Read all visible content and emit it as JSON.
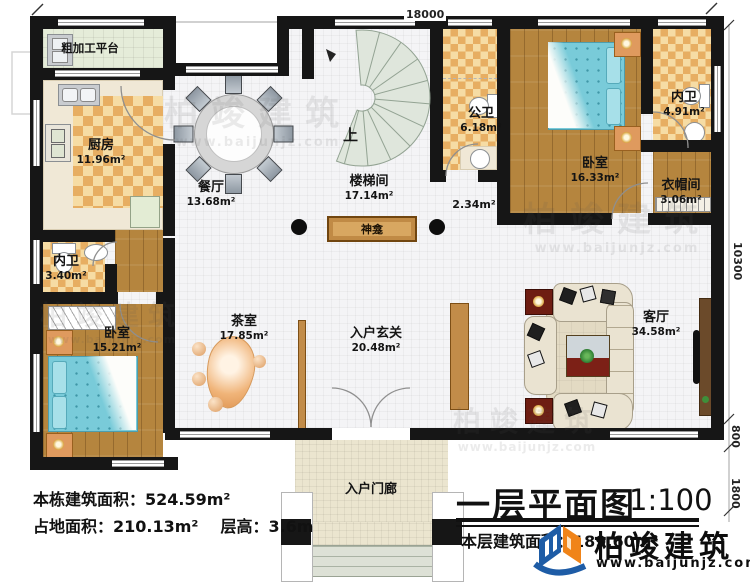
{
  "brand": {
    "name": "柏竣建筑",
    "url": "www.baijunjz.com"
  },
  "title": {
    "main": "一层平面图",
    "scale": "1:100",
    "floor_area": "本层建筑面积：189.60m²"
  },
  "stats": {
    "building_area": "本栋建筑面积：524.59m²",
    "footprint": "占地面积：210.13m²",
    "floor_height": "层高：3.6m"
  },
  "dimensions": {
    "top": "18000",
    "right": "10300",
    "bay": "800",
    "porch": "1800"
  },
  "labels": {
    "up": "上",
    "altar": "神龛",
    "corridor_area": "2.34m²"
  },
  "rooms": [
    {
      "name": "粗加工平台",
      "area": ""
    },
    {
      "name": "厨房",
      "area": "11.96m²"
    },
    {
      "name": "餐厅",
      "area": "13.68m²"
    },
    {
      "name": "楼梯间",
      "area": "17.14m²"
    },
    {
      "name": "公卫",
      "area": "6.18m²"
    },
    {
      "name": "卧室",
      "area": "16.33m²"
    },
    {
      "name": "内卫",
      "area": "4.91m²"
    },
    {
      "name": "衣帽间",
      "area": "3.06m²"
    },
    {
      "name": "内卫",
      "area": "3.40m²"
    },
    {
      "name": "卧室",
      "area": "15.21m²"
    },
    {
      "name": "茶室",
      "area": "17.85m²"
    },
    {
      "name": "入户玄关",
      "area": "20.48m²"
    },
    {
      "name": "客厅",
      "area": "34.58m²"
    },
    {
      "name": "入户门廊",
      "area": ""
    }
  ]
}
